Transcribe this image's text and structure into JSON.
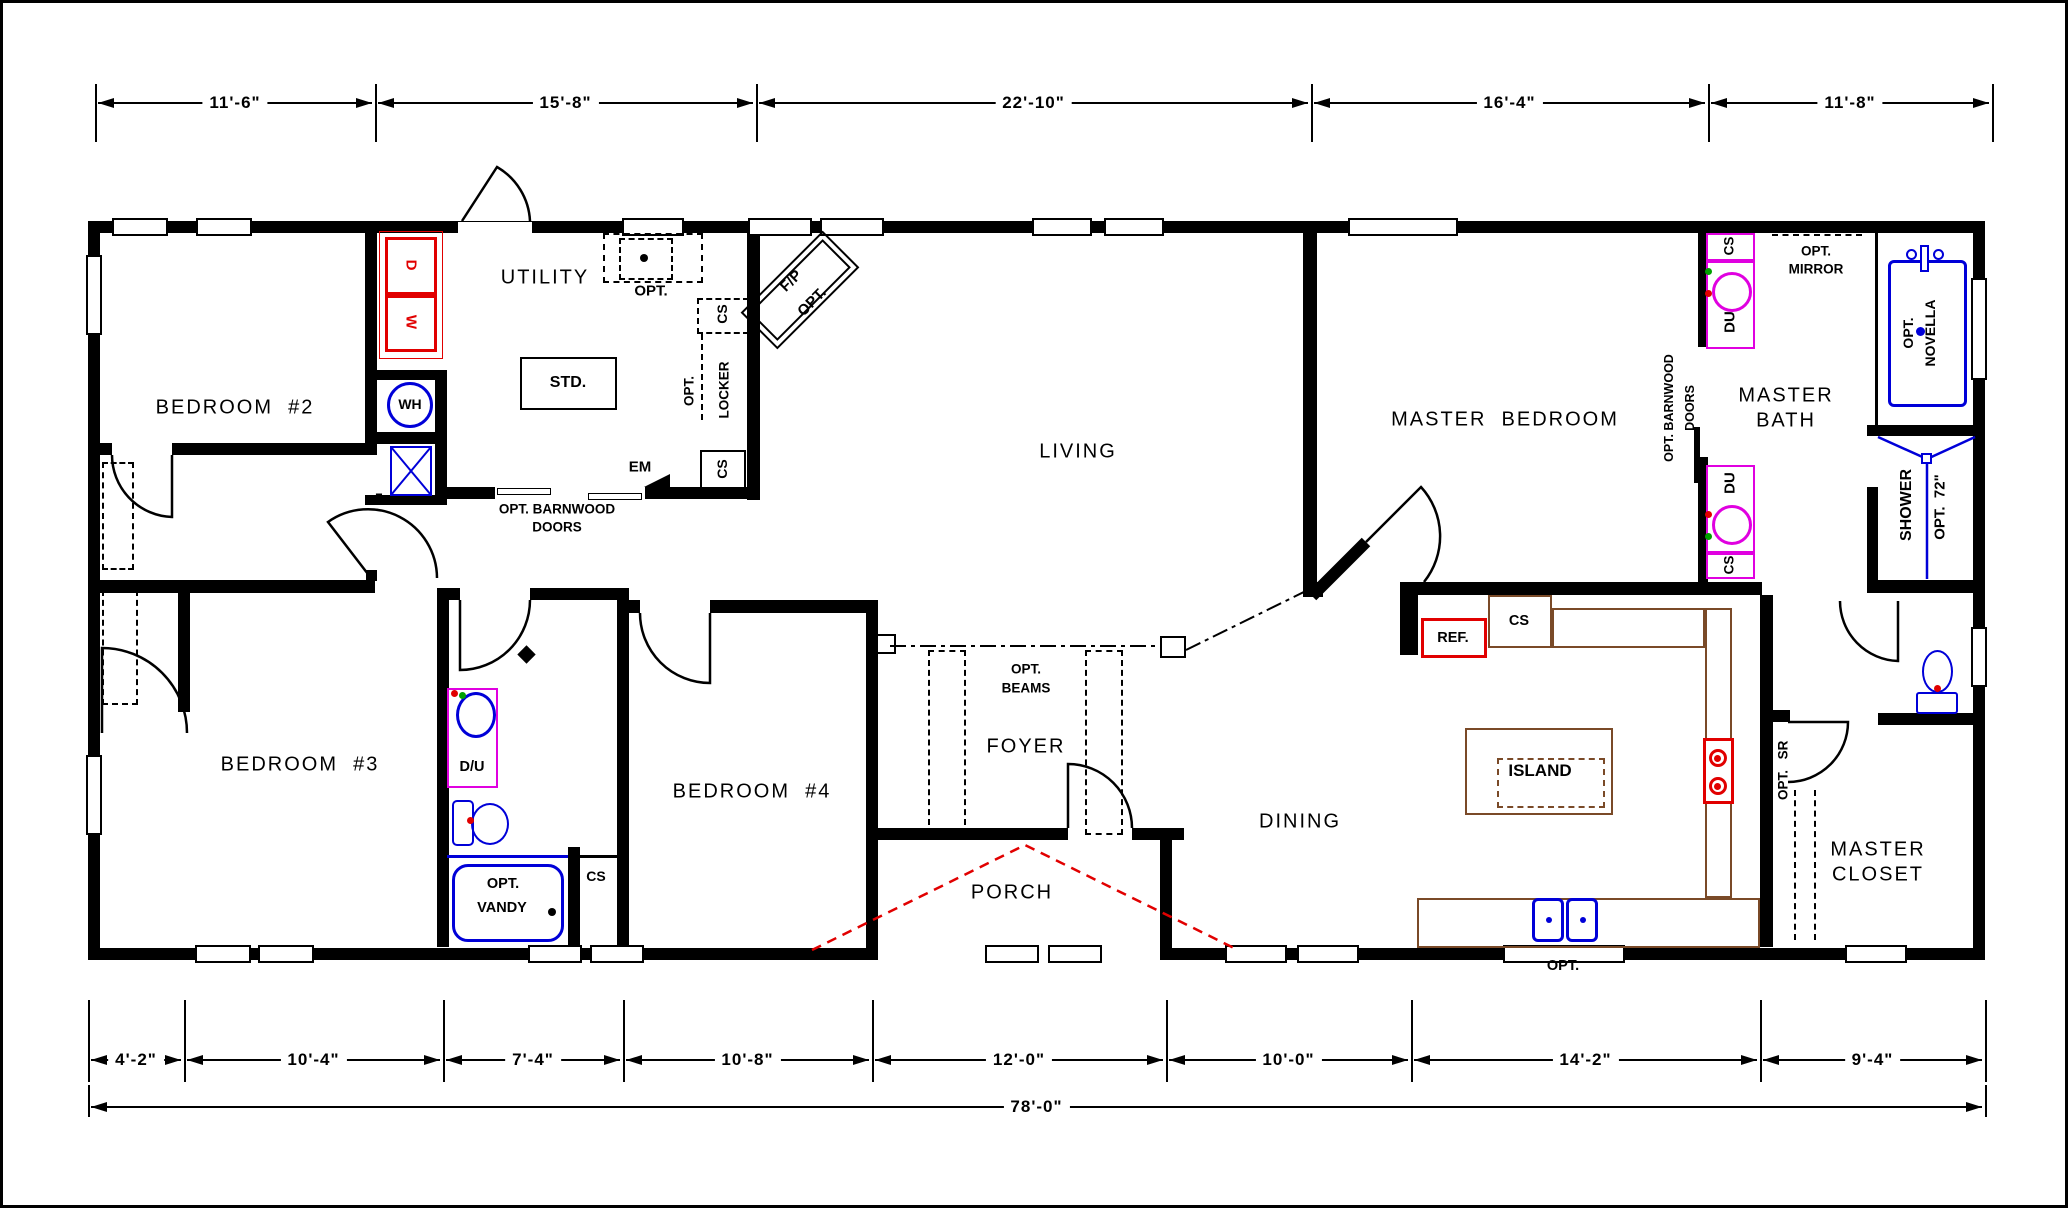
{
  "meta": {
    "type": "architectural-floor-plan"
  },
  "colors": {
    "wall": "#000000",
    "fixture_red": "#e10000",
    "fixture_blue": "#0000d8",
    "fixture_magenta": "#e000e0",
    "counter_brown": "#7a4a28",
    "porch_red": "#e10000"
  },
  "dimensions": {
    "top": {
      "y": 103,
      "tick_top": 84,
      "tick_bottom": 142,
      "ticks": [
        95,
        375,
        756,
        1311,
        1708,
        1992
      ],
      "segments": [
        {
          "label": "11'-6\"",
          "from": 95,
          "to": 375
        },
        {
          "label": "15'-8\"",
          "from": 375,
          "to": 756
        },
        {
          "label": "22'-10\"",
          "from": 756,
          "to": 1311
        },
        {
          "label": "16'-4\"",
          "from": 1311,
          "to": 1708
        },
        {
          "label": "11'-8\"",
          "from": 1708,
          "to": 1992
        }
      ]
    },
    "bottom": {
      "y": 1060,
      "tick_top": 1000,
      "tick_bottom": 1082,
      "ticks": [
        88,
        184,
        443,
        623,
        872,
        1166,
        1411,
        1760,
        1985
      ],
      "segments": [
        {
          "label": "4'-2\"",
          "from": 88,
          "to": 184
        },
        {
          "label": "10'-4\"",
          "from": 184,
          "to": 443
        },
        {
          "label": "7'-4\"",
          "from": 443,
          "to": 623
        },
        {
          "label": "10'-8\"",
          "from": 623,
          "to": 872
        },
        {
          "label": "12'-0\"",
          "from": 872,
          "to": 1166
        },
        {
          "label": "10'-0\"",
          "from": 1166,
          "to": 1411
        },
        {
          "label": "14'-2\"",
          "from": 1411,
          "to": 1760
        },
        {
          "label": "9'-4\"",
          "from": 1760,
          "to": 1985
        }
      ]
    },
    "overall": {
      "label": "78'-0\"",
      "from": 88,
      "to": 1985,
      "y": 1107,
      "tick_top": 1085,
      "tick_bottom": 1117
    }
  },
  "room_labels": [
    {
      "name": "room-bedroom-2",
      "text": "BEDROOM  #2",
      "x": 235,
      "y": 408
    },
    {
      "name": "room-bedroom-3",
      "text": "BEDROOM  #3",
      "x": 300,
      "y": 765
    },
    {
      "name": "room-bedroom-4",
      "text": "BEDROOM  #4",
      "x": 752,
      "y": 792
    },
    {
      "name": "room-utility",
      "text": "UTILITY",
      "x": 545,
      "y": 278
    },
    {
      "name": "room-living",
      "text": "LIVING",
      "x": 1078,
      "y": 452
    },
    {
      "name": "room-master-bedroom",
      "text": "MASTER  BEDROOM",
      "x": 1505,
      "y": 420
    },
    {
      "name": "room-master-bath-1",
      "text": "MASTER",
      "x": 1786,
      "y": 396
    },
    {
      "name": "room-master-bath-2",
      "text": "BATH",
      "x": 1786,
      "y": 421
    },
    {
      "name": "room-foyer",
      "text": "FOYER",
      "x": 1026,
      "y": 747
    },
    {
      "name": "room-dining",
      "text": "DINING",
      "x": 1300,
      "y": 822
    },
    {
      "name": "room-porch",
      "text": "PORCH",
      "x": 1012,
      "y": 893
    },
    {
      "name": "room-master-closet-1",
      "text": "MASTER",
      "x": 1878,
      "y": 850
    },
    {
      "name": "room-master-closet-2",
      "text": "CLOSET",
      "x": 1878,
      "y": 875
    }
  ],
  "tags": [
    {
      "name": "tag-std",
      "text": "STD.",
      "x": 568,
      "y": 383,
      "size": 16
    },
    {
      "name": "tag-wh",
      "text": "WH",
      "x": 410,
      "y": 404,
      "size": 14
    },
    {
      "name": "tag-dryer",
      "text": "D",
      "x": 411,
      "y": 265,
      "size": 15,
      "rot": 90,
      "color": "#e10000"
    },
    {
      "name": "tag-washer",
      "text": "W",
      "x": 411,
      "y": 322,
      "size": 15,
      "rot": 90,
      "color": "#e10000"
    },
    {
      "name": "tag-cs-utility-top",
      "text": "CS",
      "x": 722,
      "y": 314,
      "size": 14,
      "rot": -90
    },
    {
      "name": "tag-opt-locker",
      "text": "OPT.",
      "x": 689,
      "y": 391,
      "size": 13.5,
      "rot": -90
    },
    {
      "name": "tag-locker",
      "text": "LOCKER",
      "x": 724,
      "y": 390,
      "size": 13.5,
      "rot": -90
    },
    {
      "name": "tag-cs-utility-bot",
      "text": "CS",
      "x": 722,
      "y": 469,
      "size": 14,
      "rot": -90
    },
    {
      "name": "tag-em",
      "text": "EM",
      "x": 640,
      "y": 467,
      "size": 15
    },
    {
      "name": "tag-opt-utility-sink",
      "text": "OPT.",
      "x": 651,
      "y": 291,
      "size": 15
    },
    {
      "name": "tag-barnwood-util-1",
      "text": "OPT. BARNWOOD",
      "x": 557,
      "y": 509,
      "size": 13.5
    },
    {
      "name": "tag-barnwood-util-2",
      "text": "DOORS",
      "x": 557,
      "y": 527,
      "size": 13.5
    },
    {
      "name": "tag-seven",
      "text": "7",
      "x": 379,
      "y": 498,
      "size": 13
    },
    {
      "name": "tag-fireplace",
      "text": "F/P",
      "x": 791,
      "y": 281,
      "size": 15,
      "rot": -45
    },
    {
      "name": "tag-fireplace-opt",
      "text": "OPT.",
      "x": 812,
      "y": 302,
      "size": 15,
      "rot": -45
    },
    {
      "name": "tag-opt-beams-1",
      "text": "OPT.",
      "x": 1026,
      "y": 669,
      "size": 13.5
    },
    {
      "name": "tag-opt-beams-2",
      "text": "BEAMS",
      "x": 1026,
      "y": 688,
      "size": 13.5
    },
    {
      "name": "tag-ref",
      "text": "REF.",
      "x": 1453,
      "y": 638,
      "size": 14.5
    },
    {
      "name": "tag-cs-kitchen",
      "text": "CS",
      "x": 1519,
      "y": 621,
      "size": 14.5
    },
    {
      "name": "tag-opt-kitchen-sink",
      "text": "OPT.",
      "x": 1563,
      "y": 966,
      "size": 14.5
    },
    {
      "name": "tag-island",
      "text": "ISLAND",
      "x": 1540,
      "y": 771,
      "size": 17
    },
    {
      "name": "tag-sr",
      "text": "SR",
      "x": 1783,
      "y": 750,
      "size": 13.5,
      "rot": -90
    },
    {
      "name": "tag-sr-opt",
      "text": "OPT.",
      "x": 1783,
      "y": 785,
      "size": 13.5,
      "rot": -90
    },
    {
      "name": "tag-cs-bath-top",
      "text": "CS",
      "x": 1729,
      "y": 246,
      "size": 13.5,
      "rot": -90
    },
    {
      "name": "tag-du-1",
      "text": "DU",
      "x": 1730,
      "y": 322,
      "size": 15,
      "rot": -90
    },
    {
      "name": "tag-du-2",
      "text": "DU",
      "x": 1730,
      "y": 483,
      "size": 15,
      "rot": -90
    },
    {
      "name": "tag-cs-bath-bot",
      "text": "CS",
      "x": 1729,
      "y": 565,
      "size": 13.5,
      "rot": -90
    },
    {
      "name": "tag-opt-mirror-1",
      "text": "OPT.",
      "x": 1816,
      "y": 251,
      "size": 13.5
    },
    {
      "name": "tag-opt-mirror-2",
      "text": "MIRROR",
      "x": 1816,
      "y": 269,
      "size": 13.5
    },
    {
      "name": "tag-barnwood-mbr-1",
      "text": "OPT. BARNWOOD",
      "x": 1669,
      "y": 408,
      "size": 12.5,
      "rot": -90
    },
    {
      "name": "tag-barnwood-mbr-2",
      "text": "DOORS",
      "x": 1690,
      "y": 408,
      "size": 12.5,
      "rot": -90
    },
    {
      "name": "tag-opt-novella-1",
      "text": "OPT.",
      "x": 1908,
      "y": 333,
      "size": 14,
      "rot": -90
    },
    {
      "name": "tag-opt-novella-2",
      "text": "NOVELLA",
      "x": 1930,
      "y": 333,
      "size": 14,
      "rot": -90
    },
    {
      "name": "tag-shower",
      "text": "SHOWER",
      "x": 1907,
      "y": 505,
      "size": 16,
      "rot": -90
    },
    {
      "name": "tag-shower-opt-72",
      "text": "OPT.  72\"",
      "x": 1940,
      "y": 507,
      "size": 15,
      "rot": -90
    },
    {
      "name": "tag-du-hall",
      "text": "D/U",
      "x": 472,
      "y": 767,
      "size": 14.5
    },
    {
      "name": "tag-opt-vandy-1",
      "text": "OPT.",
      "x": 503,
      "y": 884,
      "size": 14.5
    },
    {
      "name": "tag-opt-vandy-2",
      "text": "VANDY",
      "x": 502,
      "y": 908,
      "size": 14.5
    },
    {
      "name": "tag-cs-hall-bath",
      "text": "CS",
      "x": 596,
      "y": 876,
      "size": 14
    }
  ]
}
